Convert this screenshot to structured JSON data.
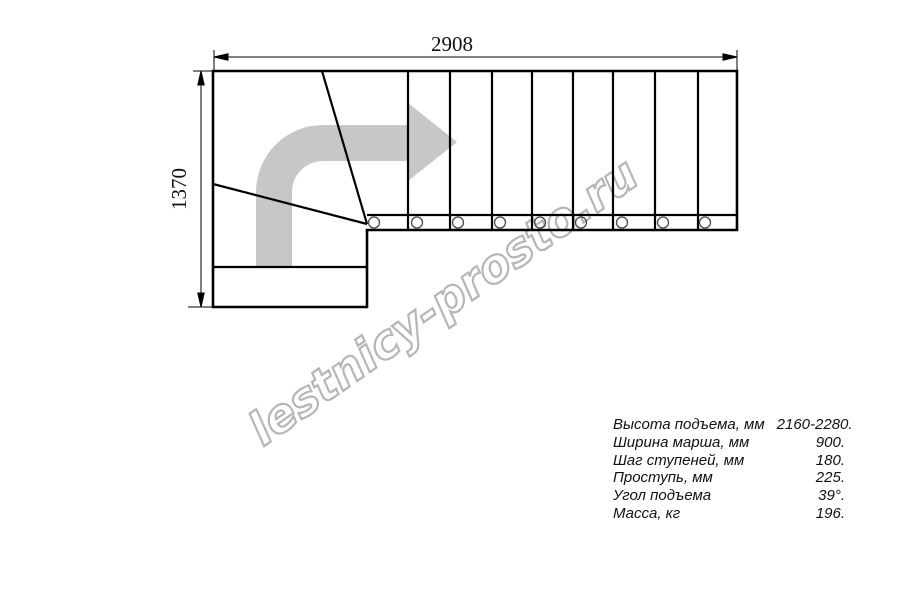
{
  "watermark": {
    "text": "lestnicy-prosto.ru",
    "color": "#b6b6b6"
  },
  "dimensions": {
    "top": {
      "value": "2908"
    },
    "left": {
      "value": "1370"
    }
  },
  "drawing": {
    "description": "L-shaped staircase plan, quarter turn with winders, direction arrow up then right",
    "line_color": "#000000",
    "arrow_color": "#c7c7c7",
    "tread_line_xs": [
      408,
      450,
      492,
      532,
      573,
      613,
      655,
      698
    ],
    "baluster_xs": [
      374,
      417,
      458,
      500,
      540,
      581,
      622,
      663,
      705
    ]
  },
  "specs": {
    "rows": [
      {
        "label": "Высота подъема, мм",
        "value": "2160-2280."
      },
      {
        "label": "Ширина марша, мм",
        "value": "900."
      },
      {
        "label": "Шаг ступеней, мм",
        "value": "180."
      },
      {
        "label": "Проступь, мм",
        "value": "225."
      },
      {
        "label": "Угол подъема",
        "value": "39°."
      },
      {
        "label": "Масса, кг",
        "value": "196."
      }
    ]
  }
}
